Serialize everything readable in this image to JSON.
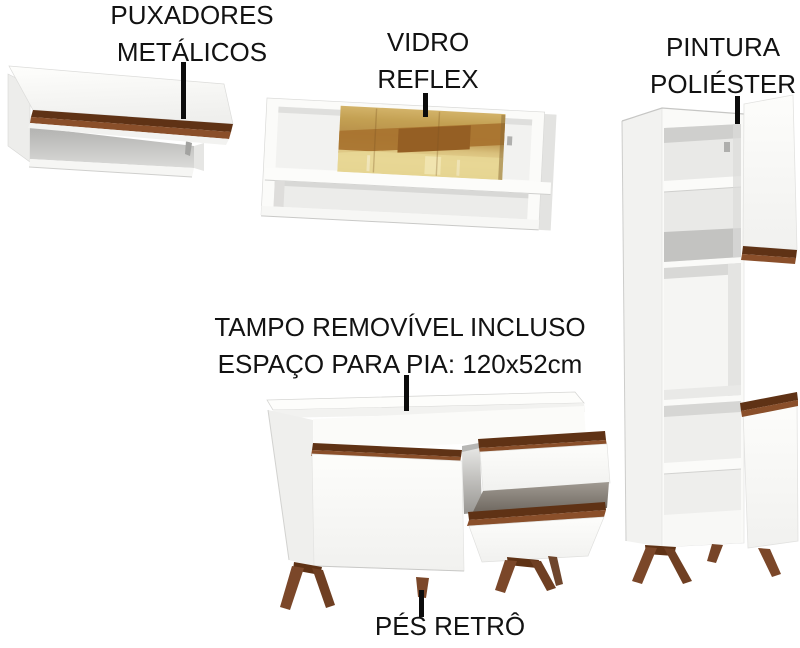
{
  "canvas": {
    "width": 800,
    "height": 648,
    "background": "#ffffff"
  },
  "palette": {
    "text": "#121212",
    "callout_line": "#0c0c0c",
    "cabinet_white": "#fbfbf9",
    "cabinet_shadow": "#e8e8e6",
    "interior_gray": "#c6c6c4",
    "wood_dark": "#5f3215",
    "wood_mid": "#7b4729",
    "wood_accent": "#8a4f2a",
    "glass_gold": "#c4a153",
    "glass_amber": "#a9742f",
    "glass_pale": "#e8d795"
  },
  "callouts": {
    "handles": {
      "line1": "PUXADORES",
      "line2": "METÁLICOS"
    },
    "glass": {
      "line1": "VIDRO",
      "line2": "REFLEX"
    },
    "paint": {
      "line1": "PINTURA",
      "line2": "POLIÉSTER"
    },
    "countertop": {
      "line1": "TAMPO REMOVÍVEL INCLUSO",
      "line2": "ESPAÇO PARA PIA: 120x52cm"
    },
    "feet": {
      "line1": "PÉS RETRÔ"
    }
  }
}
